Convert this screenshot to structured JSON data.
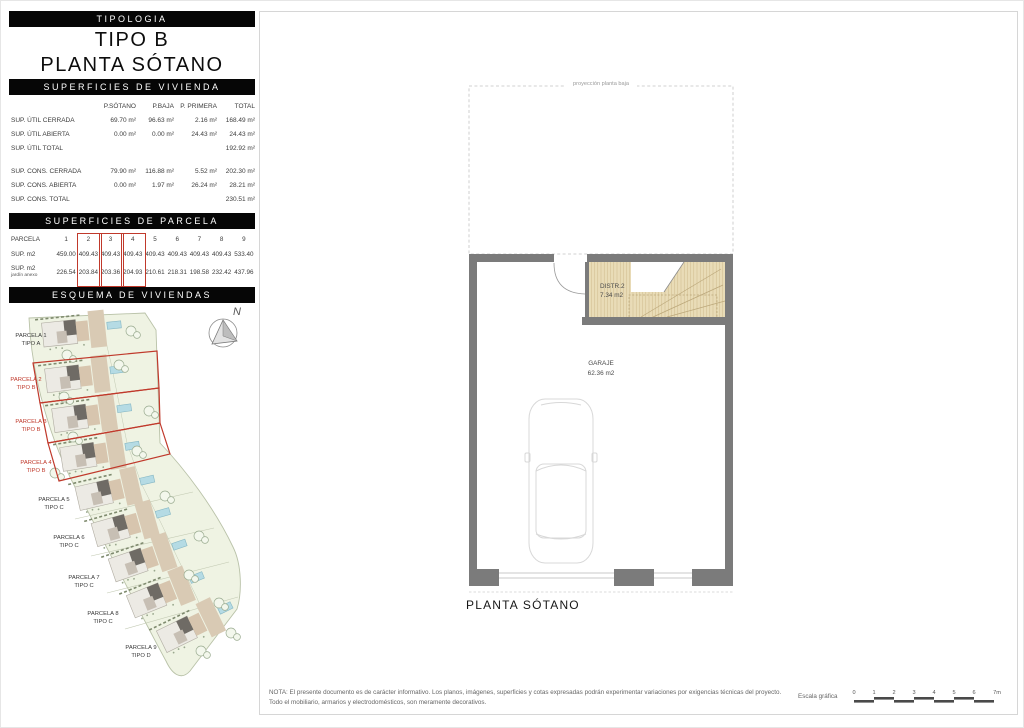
{
  "header": {
    "section_label": "TIPOLOGIA",
    "title_line1": "TIPO B",
    "title_line2": "PLANTA SÓTANO"
  },
  "vivienda_table": {
    "section_label": "SUPERFICIES DE VIVIENDA",
    "columns": [
      "P.SÓTANO",
      "P.BAJA",
      "P. PRIMERA",
      "TOTAL"
    ],
    "rows": [
      {
        "label": "SUP. ÚTIL CERRADA",
        "values": [
          "69.70 m²",
          "96.63 m²",
          "2.16 m²",
          "168.49 m²"
        ]
      },
      {
        "label": "SUP. ÚTIL ABIERTA",
        "values": [
          "0.00 m²",
          "0.00 m²",
          "24.43 m²",
          "24.43 m²"
        ]
      },
      {
        "label": "SUP. ÚTIL TOTAL",
        "values": [
          "",
          "",
          "",
          "192.92 m²"
        ]
      },
      {
        "label": "SUP. CONS. CERRADA",
        "values": [
          "79.90 m²",
          "116.88 m²",
          "5.52 m²",
          "202.30 m²"
        ]
      },
      {
        "label": "SUP. CONS. ABIERTA",
        "values": [
          "0.00 m²",
          "1.97 m²",
          "26.24 m²",
          "28.21 m²"
        ]
      },
      {
        "label": "SUP. CONS. TOTAL",
        "values": [
          "",
          "",
          "",
          "230.51 m²"
        ]
      }
    ]
  },
  "parcela_table": {
    "section_label": "SUPERFICIES DE PARCELA",
    "col_header_label": "PARCELA",
    "row_sup_label": "SUP. m2",
    "row_jardin_label_1": "SUP. m2",
    "row_jardin_label_2": "jardín anexo",
    "parcelas": [
      "1",
      "2",
      "3",
      "4",
      "5",
      "6",
      "7",
      "8",
      "9"
    ],
    "sup_m2": [
      "459.00",
      "409.43",
      "409.43",
      "409.43",
      "409.43",
      "409.43",
      "409.43",
      "409.43",
      "533.40"
    ],
    "jardin_anexo": [
      "226.54",
      "203.84",
      "203.36",
      "204.93",
      "210.61",
      "218.31",
      "198.58",
      "232.42",
      "437.96"
    ],
    "highlighted_parcelas": [
      "2",
      "3",
      "4"
    ]
  },
  "esquema": {
    "section_label": "ESQUEMA DE VIVIENDAS",
    "north_label": "N",
    "parcels": [
      {
        "name": "PARCELA 1",
        "tipo": "TIPO A",
        "highlighted": false
      },
      {
        "name": "PARCELA 2",
        "tipo": "TIPO B",
        "highlighted": true
      },
      {
        "name": "PARCELA 3",
        "tipo": "TIPO B",
        "highlighted": true
      },
      {
        "name": "PARCELA 4",
        "tipo": "TIPO B",
        "highlighted": true
      },
      {
        "name": "PARCELA 5",
        "tipo": "TIPO C",
        "highlighted": false
      },
      {
        "name": "PARCELA 6",
        "tipo": "TIPO C",
        "highlighted": false
      },
      {
        "name": "PARCELA 7",
        "tipo": "TIPO C",
        "highlighted": false
      },
      {
        "name": "PARCELA 8",
        "tipo": "TIPO C",
        "highlighted": false
      },
      {
        "name": "PARCELA 9",
        "tipo": "TIPO D",
        "highlighted": false
      }
    ]
  },
  "floor_plan": {
    "projection_label": "proyección planta baja",
    "room_distr_name": "DISTR.2",
    "room_distr_area": "7.34 m2",
    "room_garaje_name": "GARAJE",
    "room_garaje_area": "62.36 m2",
    "caption": "PLANTA SÓTANO"
  },
  "footer": {
    "note_line1": "NOTA: El presente documento es de carácter informativo. Los planos, imágenes, superficies y cotas expresadas podrán experimentar variaciones por exigencias técnicas del proyecto.",
    "note_line2": "Todo el mobiliario, armarios y electrodomésticos, son meramente decorativos.",
    "scale_label": "Escala gráfica",
    "scale_ticks": [
      "0",
      "1",
      "2",
      "3",
      "4",
      "5",
      "6",
      "7m"
    ]
  },
  "colors": {
    "accent_red": "#c0392b",
    "wall_gray": "#7b7b7b",
    "room_tan": "#e9dcb7",
    "site_green": "#eff3e3",
    "pool_blue": "#b5dbe4",
    "bar_black": "#060606"
  }
}
